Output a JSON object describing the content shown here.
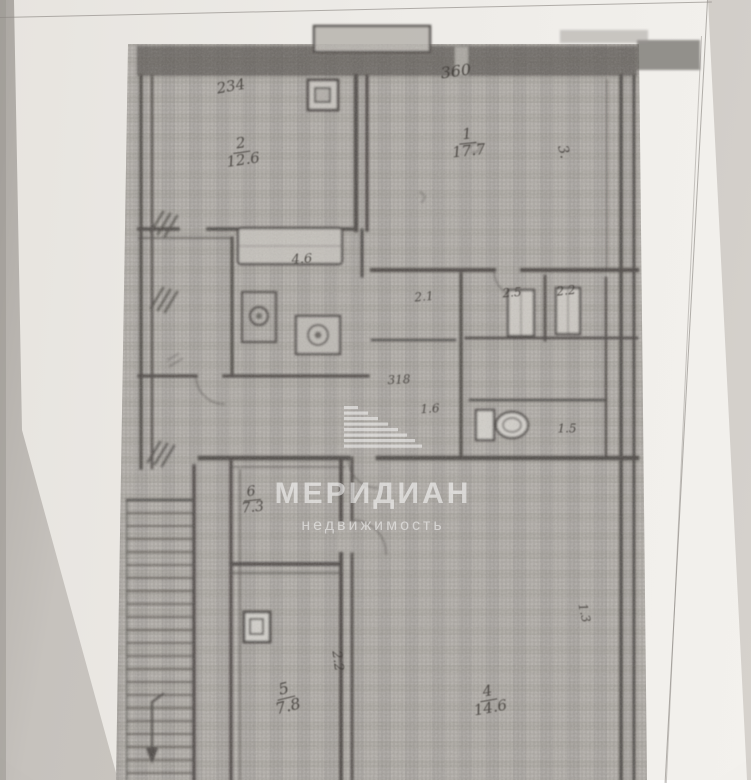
{
  "watermark": {
    "title": "МЕРИДИАН",
    "subtitle": "недвижимость",
    "logo": "meridian-stripes-sail-logo",
    "color": "#ffffff"
  },
  "plan": {
    "type": "apartment-floor-plan-scan",
    "labels": [
      {
        "name": "room-2-dimension",
        "text": "234",
        "x": 231,
        "y": 87,
        "rot": -10,
        "size": 15
      },
      {
        "name": "room-2-number-area",
        "top": "2",
        "bottom": "12.6",
        "x": 242,
        "y": 152,
        "rot": -8,
        "size": 15
      },
      {
        "name": "room-1-dimension",
        "text": "360",
        "x": 456,
        "y": 72,
        "rot": -8,
        "size": 16
      },
      {
        "name": "room-1-number-area",
        "top": "1",
        "bottom": "17.7",
        "x": 468,
        "y": 143,
        "rot": -6,
        "size": 15
      },
      {
        "name": "room-1-side-mark",
        "text": "3.",
        "x": 563,
        "y": 152,
        "rot": 75,
        "size": 14
      },
      {
        "name": "kitchen-area",
        "text": "4.6",
        "x": 302,
        "y": 260,
        "rot": -4,
        "size": 13
      },
      {
        "name": "closet-area-1",
        "text": "2.1",
        "x": 424,
        "y": 297,
        "rot": -5,
        "size": 12
      },
      {
        "name": "closet-area-2",
        "text": "2.5",
        "x": 512,
        "y": 293,
        "rot": -4,
        "size": 12
      },
      {
        "name": "closet-area-3",
        "text": "2.2",
        "x": 566,
        "y": 291,
        "rot": -6,
        "size": 12
      },
      {
        "name": "hall-dimension",
        "text": "318",
        "x": 399,
        "y": 380,
        "rot": -3,
        "size": 12
      },
      {
        "name": "hall-area",
        "text": "1.6",
        "x": 430,
        "y": 409,
        "rot": -3,
        "size": 12
      },
      {
        "name": "wc-area",
        "text": "1.5",
        "x": 567,
        "y": 429,
        "rot": 0,
        "size": 12
      },
      {
        "name": "hallway-number-area",
        "top": "6",
        "bottom": "7.3",
        "x": 252,
        "y": 500,
        "rot": -6,
        "size": 14
      },
      {
        "name": "room-5-number-area",
        "top": "5",
        "bottom": "7.8",
        "x": 286,
        "y": 698,
        "rot": -14,
        "size": 16
      },
      {
        "name": "door-dimension-rotated",
        "text": "2.2",
        "x": 337,
        "y": 661,
        "rot": 82,
        "size": 13
      },
      {
        "name": "room-4-number-area",
        "top": "4",
        "bottom": "14.6",
        "x": 489,
        "y": 700,
        "rot": -10,
        "size": 15
      },
      {
        "name": "room-4-side-dimension",
        "text": "1.3",
        "x": 584,
        "y": 613,
        "rot": 78,
        "size": 12
      }
    ]
  },
  "colors": {
    "backdrop": "#c9c5c0",
    "paper": "#efedea",
    "plan_background": "#b6b2ad",
    "ink": "#45413d",
    "watermark_white": "#ffffff"
  }
}
